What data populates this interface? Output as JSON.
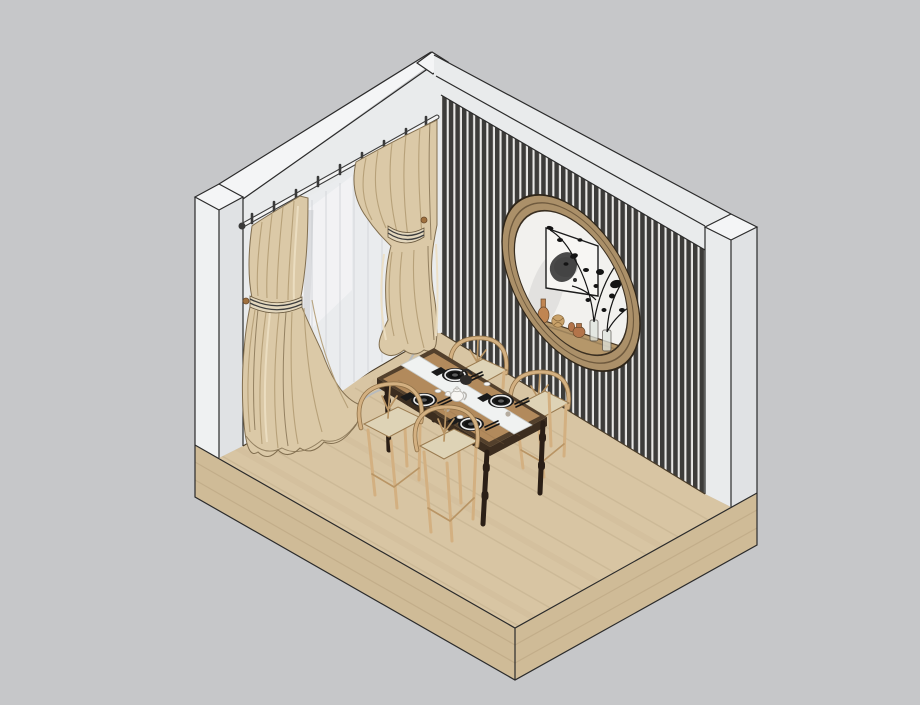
{
  "meta": {
    "title": "Isometric 3D render of a dining room corner",
    "description": "SketchUp-style axonometric interior: white wall with beige drapes and sheer window panel, black vertical-slat feature wall with round wood-framed niche, light oak floor slab, wood dining table with runner, tea set and four place settings, four wishbone chairs"
  },
  "palette": {
    "background": "#c6c7c9",
    "outline": "#2b2b2b",
    "baseline": "#4a3c28",
    "wall_face": "#e9ebec",
    "wall_top": "#f4f5f6",
    "wall_bright": "#eff1f2",
    "wall_side": "#e0e2e4",
    "slat_dark": "#3d3c3a",
    "slat_light": "#e9e8e6",
    "floor_top": "#d8c5a3",
    "floor_side": "#cfbb97",
    "floor_grain": "#8a6f4e",
    "curtain": "#dbc9a7",
    "curtain_shadow": "#b29c74",
    "curtain_deep": "#826f50",
    "curtain_light": "#ecdfc3",
    "sheer": "#eaecee",
    "sheer_streak": "#d3d6d9",
    "sheer_hem": "#b8bbbd",
    "rod": "#f4f4f4",
    "metal_dark": "#3a3a3a",
    "tie_band": "#e3d7bd",
    "tie_stripe": "#3e3e3e",
    "hook_wood": "#a0713f",
    "niche_frame": "#ab9069",
    "niche_frame_dark": "#6f5a3e",
    "niche_interior": "#f2f1ee",
    "shelf_wood": "#b5976a",
    "art_paper": "#f7f6f3",
    "art_ink": "#2c2c2c",
    "terracotta": "#b3744a",
    "terracotta_light": "#c08552",
    "basket": "#c9a26a",
    "glass": "#dfe4de",
    "plant": "#141414",
    "table_trim": "#53402c",
    "table_side": "#3c2d1f",
    "table_wood": "#b28a5c",
    "leg_dark": "#2b1f16",
    "runner": "#f0f2f1",
    "plate_dark": "#1d1d1d",
    "plate_rim": "#ececec",
    "chair_wood": "#d3b081",
    "chair_wood_dark": "#8f7148",
    "chair_seat": "#ded3b6",
    "teapot": "#f7f6f3",
    "kettle": "#2e2c2a"
  },
  "scene": {
    "objects": [
      {
        "id": "left-wall",
        "label": "white wall with window"
      },
      {
        "id": "right-wall",
        "label": "black vertical slat feature wall"
      },
      {
        "id": "curtain-rod",
        "label": "white curtain rod with dark rings"
      },
      {
        "id": "sheer-curtain",
        "label": "sheer white curtain panel"
      },
      {
        "id": "left-drape",
        "label": "beige drape with striped tieback"
      },
      {
        "id": "right-drape",
        "label": "beige drape with striped tieback"
      },
      {
        "id": "round-niche",
        "label": "round wood-framed wall niche"
      },
      {
        "id": "wall-art",
        "label": "framed ink artwork"
      },
      {
        "id": "decor-plant",
        "label": "black-leaf branch arrangement"
      },
      {
        "id": "shelf-vases",
        "label": "terracotta jars, basket ball and glass vases"
      },
      {
        "id": "floor-slab",
        "label": "light oak floor slab"
      },
      {
        "id": "dining-table",
        "label": "wood dining table with dark trim"
      },
      {
        "id": "table-runner",
        "label": "white table runner"
      },
      {
        "id": "place-settings",
        "label": "four black plate settings with chopsticks"
      },
      {
        "id": "tea-set",
        "label": "white teapot, cups and dark kettle"
      },
      {
        "id": "wishbone-chairs",
        "label": "four wishbone dining chairs"
      }
    ]
  }
}
